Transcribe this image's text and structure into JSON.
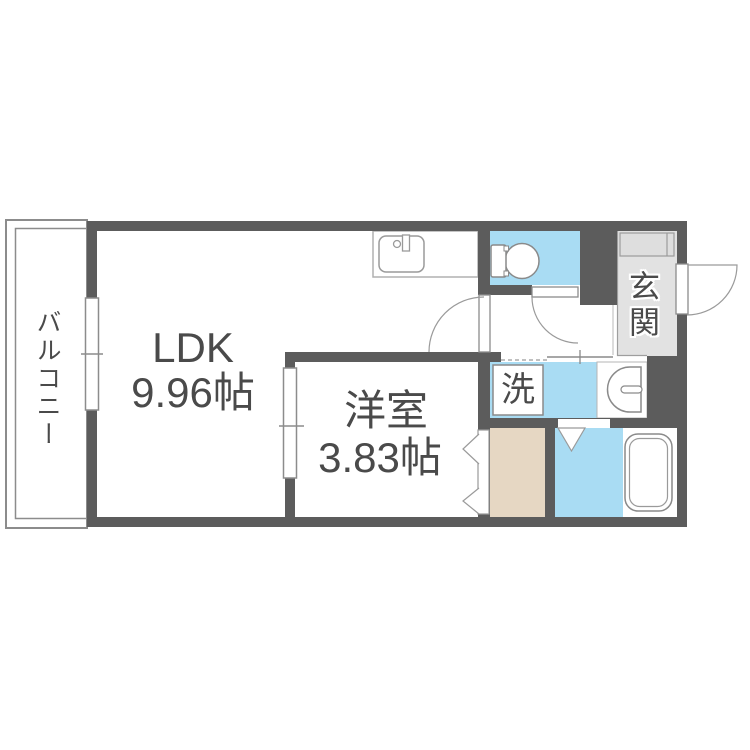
{
  "rooms": {
    "balcony": {
      "label": "バルコニー"
    },
    "ldk": {
      "label": "LDK",
      "area": "9.96帖"
    },
    "western_room": {
      "label": "洋室",
      "area": "3.83帖"
    },
    "entrance": {
      "label": "玄関"
    },
    "laundry": {
      "label": "洗"
    }
  },
  "fixtures": {
    "kitchen_sink": "kitchen-sink-icon",
    "toilet": "toilet-icon",
    "wash_basin": "wash-basin-icon",
    "bathtub": "bathtub-icon",
    "washing_machine_space": "washing-machine-space",
    "shoe_cabinet": "shoe-cabinet"
  },
  "colors": {
    "wall": "#5c5c5c",
    "water_area_blue": "#a9dcf3",
    "entrance_floor_gray": "#e2e2e2",
    "shoebox_gray": "#dedede",
    "closet_beige": "#e6d7c3",
    "outline_gray": "#8c8c8c",
    "fixture_gray": "#9a9a9a",
    "text": "#4a4a4a"
  }
}
